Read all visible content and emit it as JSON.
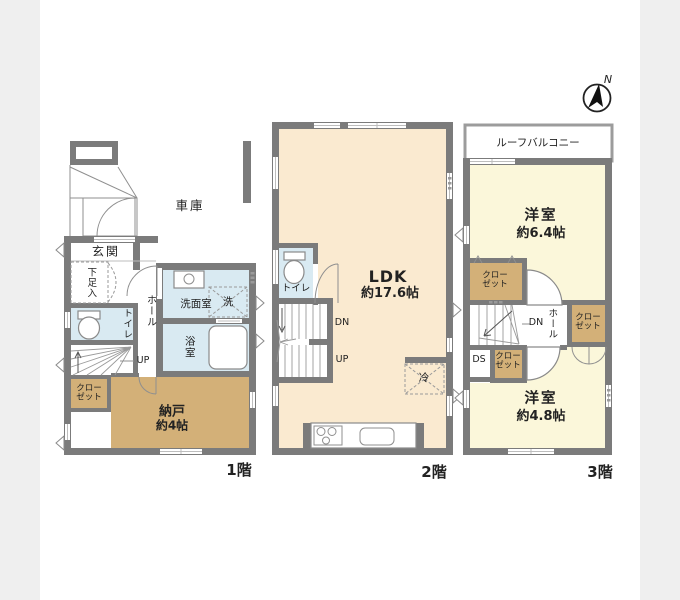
{
  "title": "3-story house floor plan",
  "compass": {
    "north_label": "N"
  },
  "colors": {
    "background": "#efefef",
    "paper": "#ffffff",
    "wall": "#7b7b7b",
    "room_cream": "#faead0",
    "room_tan": "#d3b078",
    "room_blue": "#d9eaf2",
    "room_yellow": "#fbf7da",
    "line": "#8f8f8f",
    "text": "#222222"
  },
  "floors": {
    "f1": {
      "floor_label": "1階",
      "rooms": {
        "garage": "車庫",
        "entrance": "玄関",
        "shoe_cabinet": "下足入",
        "toilet": "トイレ",
        "hall": "ホール",
        "washroom": "洗面室",
        "washer": "洗",
        "bathroom": "浴室",
        "closet_line1": "クロー",
        "closet_line2": "ゼット",
        "storage_name": "納戸",
        "storage_size": "約4帖",
        "stairs_up": "UP"
      }
    },
    "f2": {
      "floor_label": "2階",
      "rooms": {
        "toilet": "トイレ",
        "ldk_name": "LDK",
        "ldk_size": "約17.6帖",
        "stairs_dn": "DN",
        "stairs_up": "UP",
        "fridge": "冷"
      }
    },
    "f3": {
      "floor_label": "3階",
      "rooms": {
        "roof_balcony": "ルーフバルコニー",
        "bedroom1_name": "洋室",
        "bedroom1_size": "約6.4帖",
        "closet1_line1": "クロー",
        "closet1_line2": "ゼット",
        "hall": "ホール",
        "stairs_dn": "DN",
        "duct_space": "DS",
        "closet2_line1": "クロー",
        "closet2_line2": "ゼット",
        "closet3_line1": "クロー",
        "closet3_line2": "ゼット",
        "bedroom2_name": "洋室",
        "bedroom2_size": "約4.8帖"
      }
    }
  }
}
